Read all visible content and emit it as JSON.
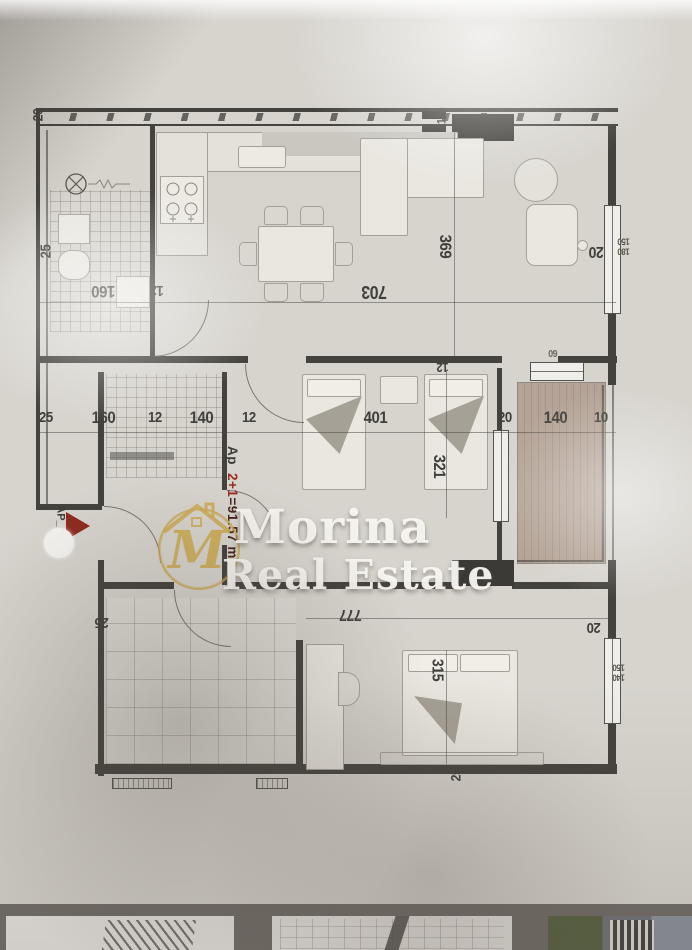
{
  "colors": {
    "ink": "#44423d",
    "accent_red": "#8e2a1e",
    "logo_gold": "#c8a452",
    "paper": "#d7d4ce",
    "balcony_wood": "#b2a195",
    "band": "#6f6b66",
    "watermark_white": "#f5f3ef"
  },
  "watermark": {
    "line1": "Morina",
    "line2": "Real Estate",
    "monogram": "M"
  },
  "unit": {
    "prefix": "Ap_",
    "type": "2+1",
    "area": "=91.57 m"
  },
  "entry": {
    "label": "AP_"
  },
  "dims": {
    "wall_top_left": "20",
    "bath_side": "25",
    "bath_width": "160",
    "bath_wall": "12",
    "living_width": "703",
    "living_depth": "369",
    "flue_width": "120",
    "right_wall": "20",
    "living_window": {
      "w": "180",
      "h": "150"
    },
    "chain": [
      "25",
      "160",
      "12",
      "140",
      "12"
    ],
    "bedroom_width": "401",
    "bedroom_depth": "321",
    "bedroom_wall": "12",
    "balcony_wall": "20",
    "balcony_width": "140",
    "balcony_rail": "10",
    "balcony_vent": "60",
    "bedroom2_width": "777",
    "bed_width": "315",
    "bottom_wall": "25",
    "left_wall_lower": "25",
    "right_wall_lower": "20",
    "bedroom_window": {
      "w": "140",
      "h": "150"
    }
  }
}
